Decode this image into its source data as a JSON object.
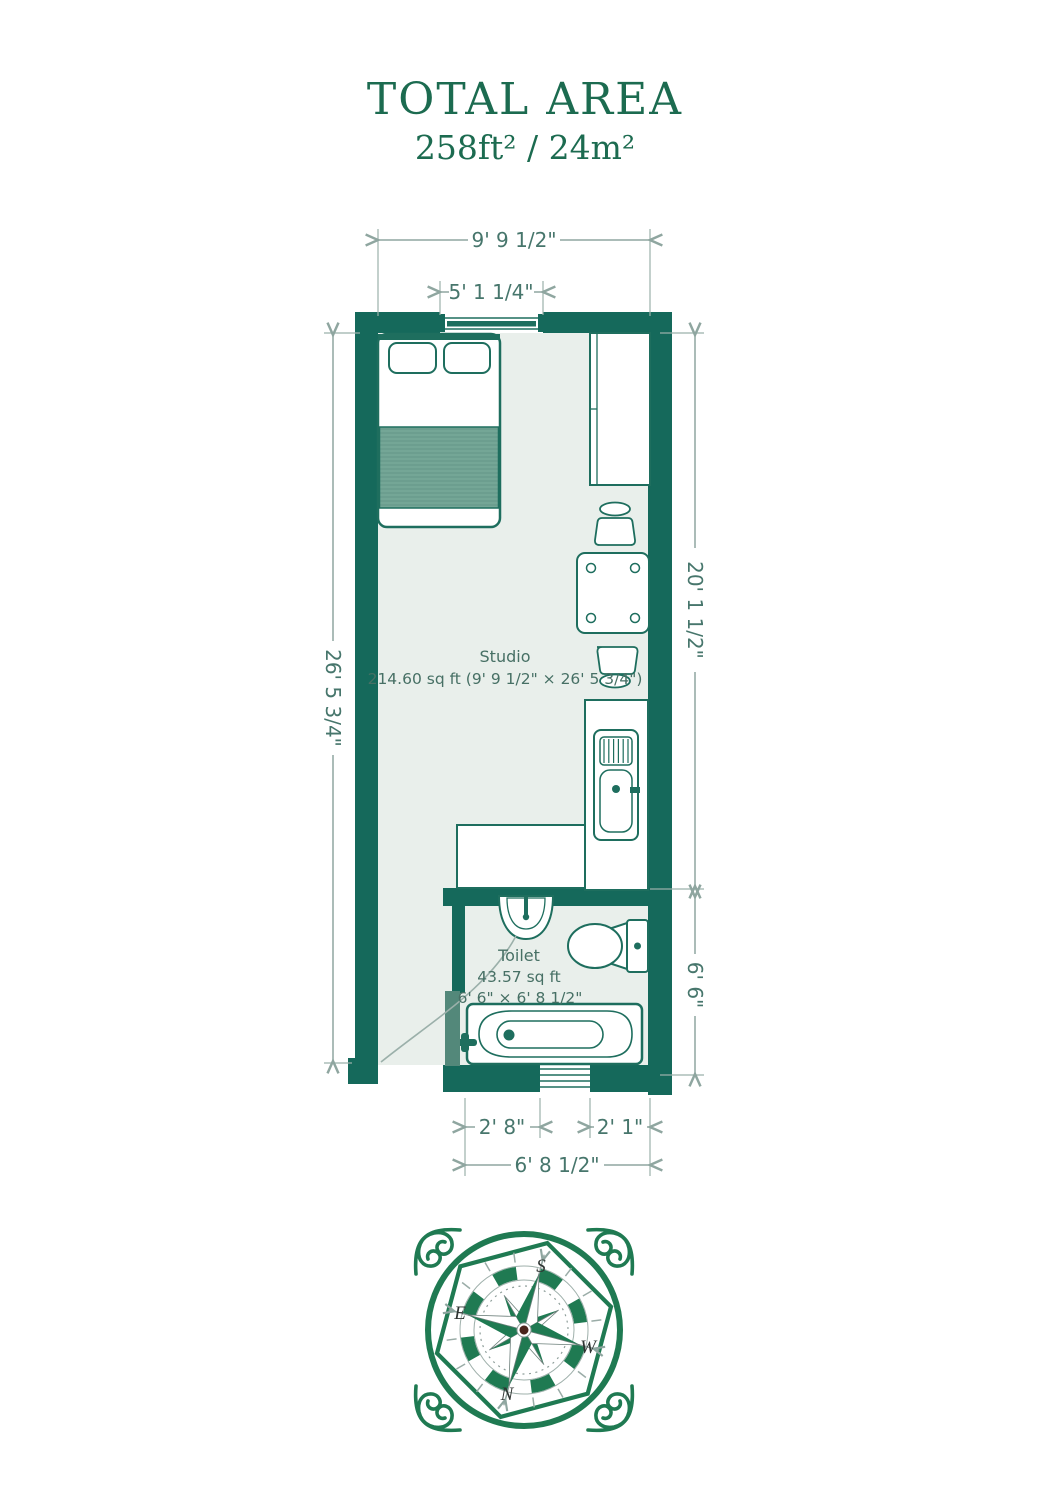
{
  "header": {
    "title": "TOTAL AREA",
    "area": "258ft² / 24m²"
  },
  "plan": {
    "dimensions": {
      "top_outer": "9' 9 1/2\"",
      "top_inner": "5' 1 1/4\"",
      "left": "26' 5 3/4\"",
      "right_upper": "20' 1 1/2\"",
      "right_lower": "6' 6\"",
      "bottom_left": "2' 8\"",
      "bottom_right": "2' 1\"",
      "bottom_total": "6' 8 1/2\""
    },
    "rooms": {
      "studio": {
        "name": "Studio",
        "details": "214.60 sq ft (9' 9 1/2\" × 26' 5 3/4\")"
      },
      "toilet": {
        "name": "Toilet",
        "area": "43.57 sq ft",
        "size": "6' 6\" × 6' 8 1/2\""
      }
    }
  },
  "compass": {
    "north": "N",
    "south": "S",
    "east": "E",
    "west": "W"
  },
  "colors": {
    "wall": "#15695B",
    "floor": "#E9EFEB",
    "furniture_outline": "#1E6E5E",
    "blanket": "#74A696",
    "door_leaf": "#53887A",
    "dimension_line": "#8FA6A0",
    "dimension_text": "#47766C",
    "title_green": "#1C6B50",
    "compass_green": "#1F7A52"
  }
}
